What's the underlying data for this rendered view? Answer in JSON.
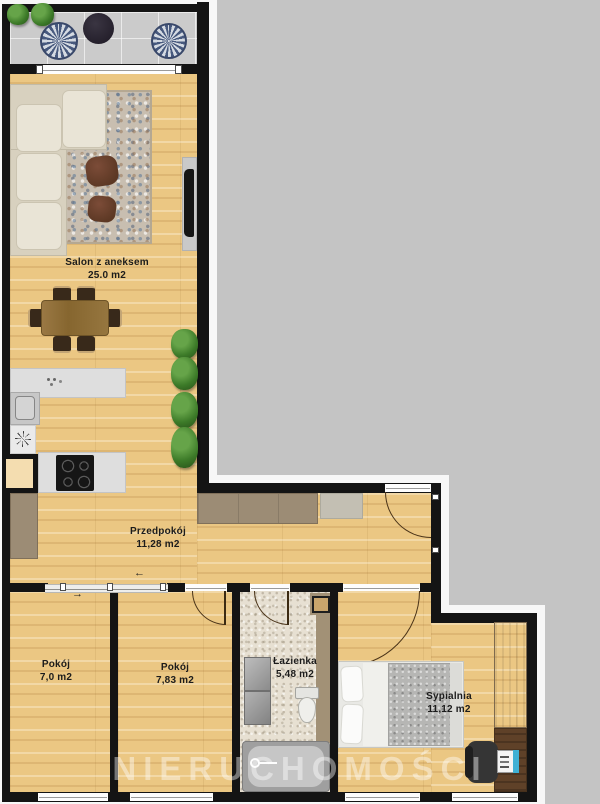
{
  "plan": {
    "watermark": "NIERUCHOMOŚCI",
    "rooms": [
      {
        "name": "Salon z aneksem",
        "area": "25.0 m2"
      },
      {
        "name": "Przedpokój",
        "area": "11,28 m2"
      },
      {
        "name": "Pokój",
        "area": "7,0 m2"
      },
      {
        "name": "Pokój",
        "area": "7,83 m2"
      },
      {
        "name": "Łazienka",
        "area": "5,48 m2"
      },
      {
        "name": "Sypialnia",
        "area": "11,12 m2"
      }
    ],
    "symbols": {
      "arrow_right": "→",
      "arrow_left": "←"
    },
    "colors": {
      "background": "#c4c4c4",
      "wall": "#141414",
      "wood_floor": "#ebc783",
      "bathroom_floor": "#e7e0d2",
      "balcony_floor": "#cbcbcb",
      "wardrobe": "#9c8c75",
      "label_text": "#1c1c1c"
    }
  }
}
